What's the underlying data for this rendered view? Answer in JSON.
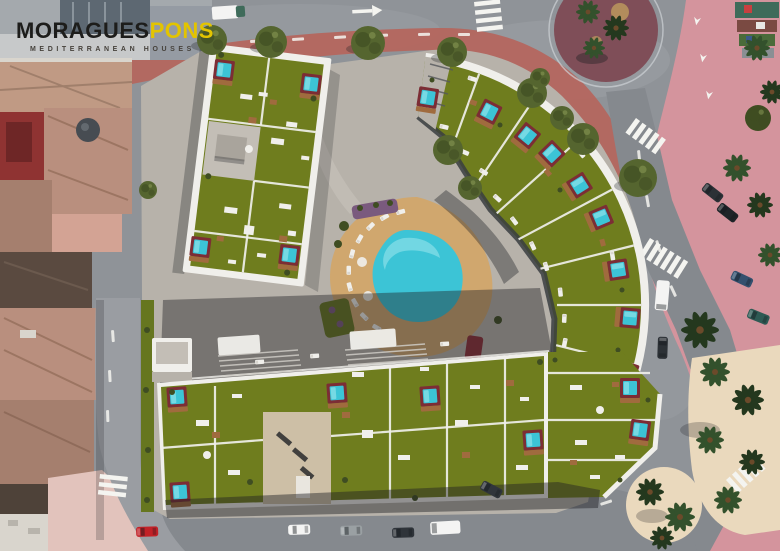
{
  "logo": {
    "brand": "MORAGUES",
    "brand_accent": "PONS",
    "tagline": "MEDITERRANEAN HOUSES"
  },
  "palette": {
    "asphalt": "#8f9398",
    "asphalt_dark": "#85898e",
    "street_light": "#9a9da2",
    "marking_white": "#f4f4f0",
    "promenade_pink": "#d4949d",
    "plaza_pink_light": "#e2c3bc",
    "sidewalk_brick": "#b5655c",
    "sand": "#ead9bd",
    "sand_patch": "#bf9c5e",
    "roundabout_center": "#7f4e58",
    "podium": "#b7b2aa",
    "podium_light": "#c3beb6",
    "parapet": "#f0efeb",
    "facade_dark": "#3a3d41",
    "lawn": "#6f7d1e",
    "lawn_dark": "#55641a",
    "hedge": "#66761f",
    "pool_water": "#3cc4d6",
    "pool_light": "#8fe2ea",
    "pool_frame": "#7c2d35",
    "deck_wood": "#a06b3e",
    "deck_tan": "#d0a76e",
    "core_beige": "#cdbfa6",
    "tree_olive": "#55652f",
    "tree_olive_dark": "#3f4d22",
    "palm": "#33512c",
    "palm_dark": "#24381e",
    "trunk": "#6b4a2a",
    "old_roof_a": "#c09a84",
    "old_roof_b": "#b98f7e",
    "old_roof_c": "#a57f6e",
    "old_roof_red": "#8f3332",
    "old_roof_dark": "#5a4a40",
    "old_roof_deep": "#4e4239",
    "old_patio_pink": "#d3a394",
    "old_white": "#d9d5cd",
    "shadow": "#1e2024",
    "car_white": "#f4f4f3",
    "car_gray": "#9aa0a3",
    "car_dark": "#2c3136",
    "car_red": "#c22127",
    "car_blue": "#33506e",
    "car_teal": "#2e6e64",
    "planter_mauve": "#7a5a7e",
    "planter_red": "#8e3038",
    "photo_gray": "#a4a9ad",
    "photo_dark": "#5d6872",
    "photo_light": "#c7c9ca",
    "stall_green": "#3f6b5a",
    "stall_red": "#7a4a42",
    "logo_black": "#1d1d1b",
    "logo_gold": "#e3c400",
    "logo_tagline": "#46423c"
  }
}
